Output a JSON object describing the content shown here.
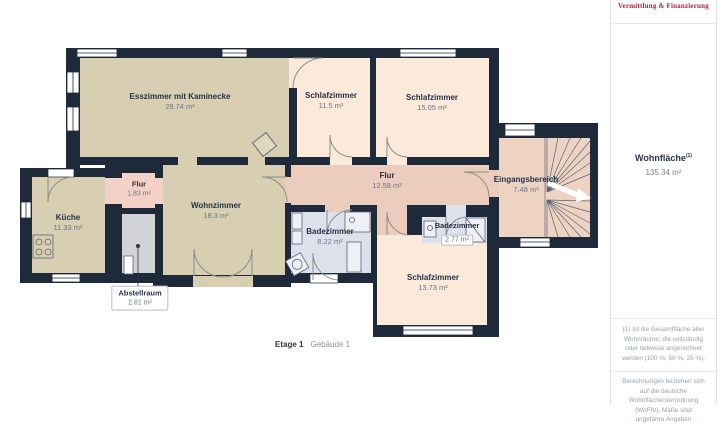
{
  "floorplan": {
    "rooms": {
      "esszimmer": {
        "name": "Esszimmer mit Kaminecke",
        "area": "29.74 m²"
      },
      "schlafzimmer1": {
        "name": "Schlafzimmer",
        "area": "11.5 m²"
      },
      "schlafzimmer2": {
        "name": "Schlafzimmer",
        "area": "15.05 m²"
      },
      "flur_klein": {
        "name": "Flur",
        "area": "1.83 m²"
      },
      "kueche": {
        "name": "Küche",
        "area": "11.33 m²"
      },
      "wohnzimmer": {
        "name": "Wohnzimmer",
        "area": "18.3 m²"
      },
      "flur": {
        "name": "Flur",
        "area": "12.58 m²"
      },
      "eingangsbereich": {
        "name": "Eingangsbereich",
        "area": "7.48 m²"
      },
      "badezimmer_gross": {
        "name": "Badezimmer",
        "area": "8.22 m²"
      },
      "badezimmer_klein": {
        "name": "Badezimmer",
        "area": "2.77 m²"
      },
      "schlafzimmer3": {
        "name": "Schlafzimmer",
        "area": "13.73 m²"
      },
      "abstellraum": {
        "name": "Abstellraum",
        "area": "2.81 m²"
      }
    },
    "footer": {
      "floor": "Etage 1",
      "building": "Gebäude 1"
    }
  },
  "sidebar": {
    "brand": "Vermittlung & Finanzierung",
    "area_label": "Wohnfläche",
    "area_sup": "(1)",
    "area_value": "135.34 m²",
    "note1": "(1) Ist die Gesamtfläche aller Wohnräume, die vollständig oder teilweise angerechnet werden (100 %, 50 %, 25 %).",
    "note2": "Berechnungen beziehen sich auf die deutsche Wohnflächenverordnung (WoFlV). Maße sind ungefähre Angaben"
  },
  "colors": {
    "wall": "#1e2a3a",
    "living": "#d8cfb2",
    "bedroom": "#fbeada",
    "hallway": "#ecccbc",
    "hallway_small": "#f3d1c6",
    "entrance": "#eed3c3",
    "bathroom": "#dde1ec",
    "storage": "#d2d3d6",
    "brand": "#b0243c"
  }
}
